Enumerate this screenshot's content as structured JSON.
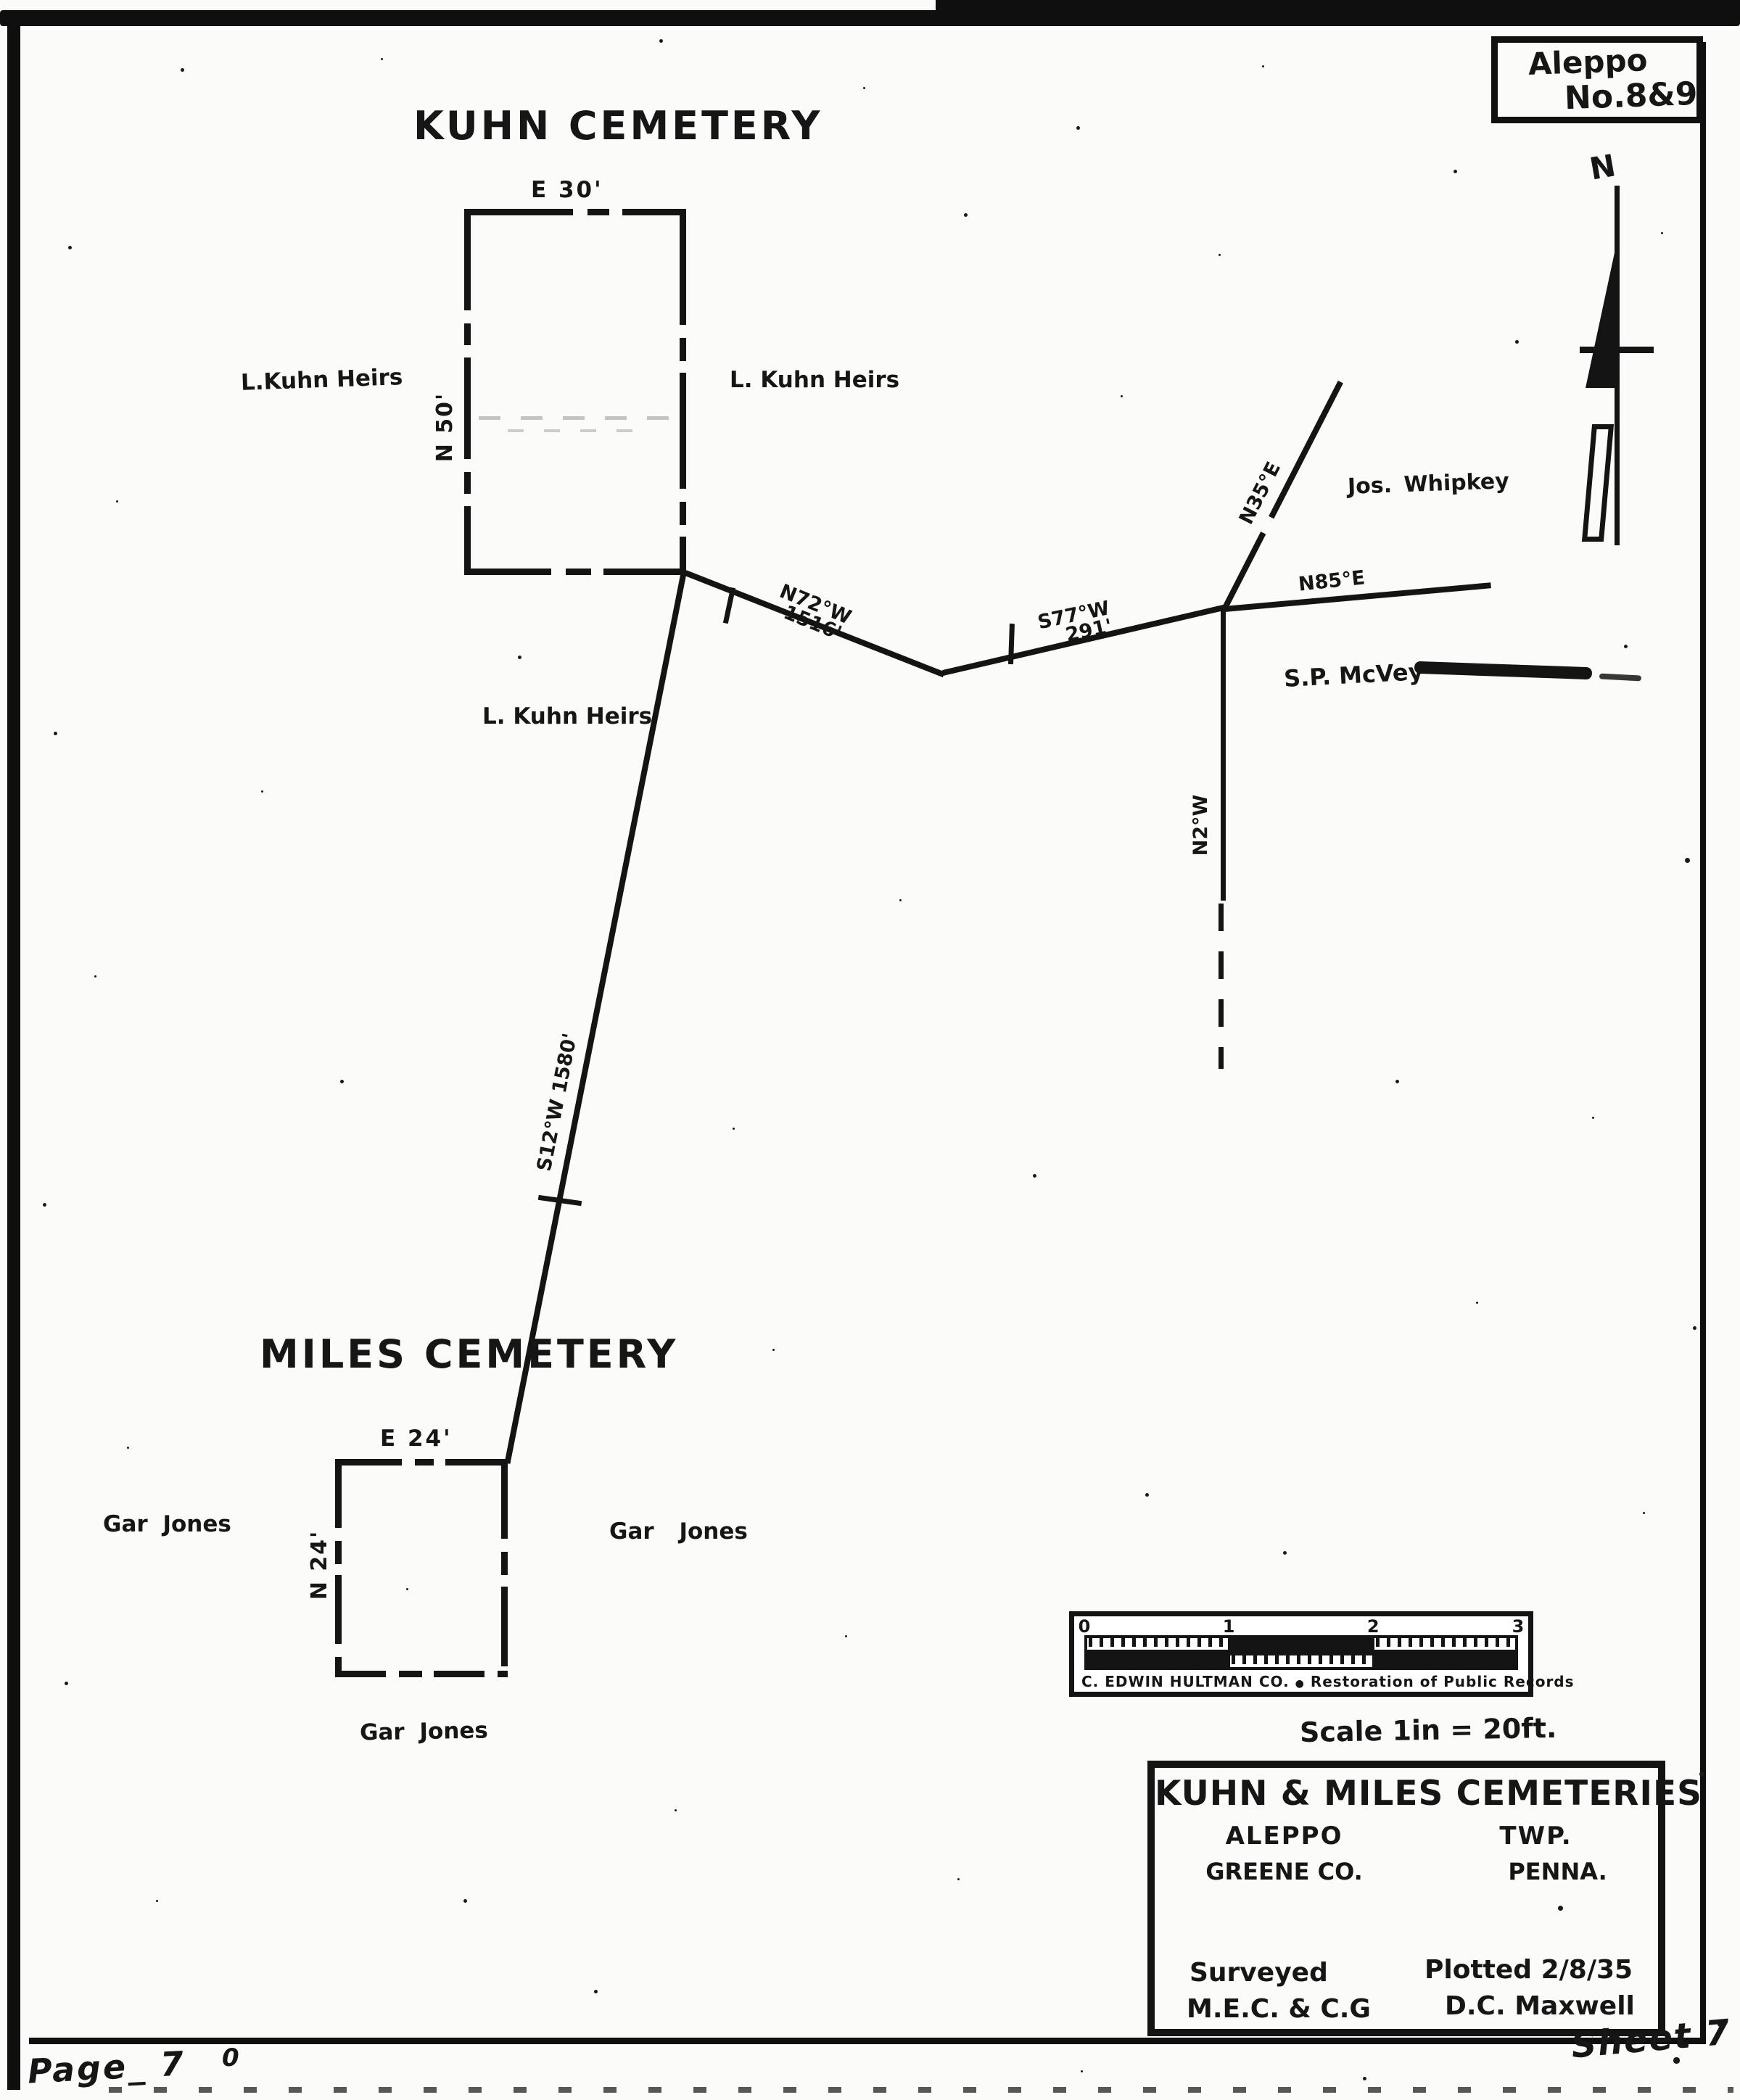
{
  "corner": {
    "line1": "Aleppo",
    "line2": "No.8&9"
  },
  "compass": {
    "n": "N"
  },
  "kuhn": {
    "title": "KUHN CEMETERY",
    "dim_top": "E 30'",
    "dim_side": "N 50'",
    "owner_left": "L.Kuhn Heirs",
    "owner_right": "L. Kuhn Heirs",
    "owner_below": "L. Kuhn Heirs"
  },
  "lines": {
    "n72": {
      "bearing": "N72°W",
      "distance": "1516'"
    },
    "s77": {
      "bearing": "S77°W",
      "distance": "291'"
    },
    "n85": "N85°E",
    "n35": "N35°E",
    "n2": "N2°W",
    "s12": "S12°W 1580'"
  },
  "neighbors": {
    "whipkey": "Jos. Whipkey",
    "mcvey": "S.P. McVey"
  },
  "miles": {
    "title": "MILES CEMETERY",
    "dim_top": "E 24'",
    "dim_side": "N 24'",
    "owner_left": "Gar Jones",
    "owner_right": "Gar Jones",
    "owner_below": "Gar Jones"
  },
  "scale_bar": {
    "ticks": [
      "0",
      "1",
      "2",
      "3"
    ],
    "credit": "C. EDWIN HULTMAN CO.",
    "separator": "●",
    "credit_note": "Restoration of Public Records"
  },
  "scale_note": "Scale 1in = 20ft.",
  "title_block": {
    "title": "KUHN & MILES CEMETERIES",
    "township": "ALEPPO",
    "township_suffix": "TWP.",
    "county": "GREENE CO.",
    "state": "PENNA.",
    "surveyed_label": "Surveyed",
    "surveyed_by": "M.E.C. & C.G",
    "plotted": "Plotted 2/8/35",
    "plotted_by": "D.C. Maxwell"
  },
  "footer": {
    "page": "Page_ 7",
    "stray": "0",
    "sheet": "Sheet 7"
  }
}
